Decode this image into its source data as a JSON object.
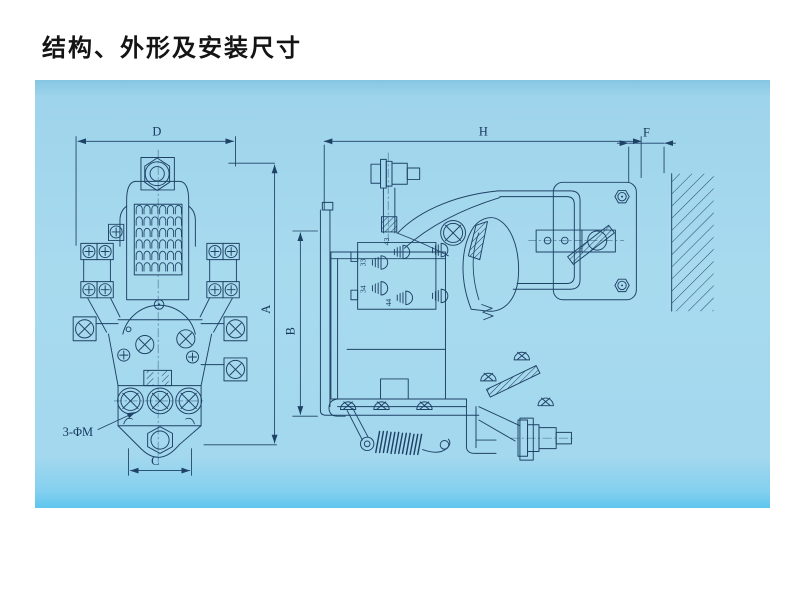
{
  "page": {
    "title": "结构、外形及安装尺寸"
  },
  "figure": {
    "kind": "engineering blueprint, contactor outline and mounting drawing, two views",
    "labels": {
      "d": "D",
      "a": "A",
      "c": "C",
      "holes": "3-ΦM",
      "h": "H",
      "f": "F",
      "b": "B",
      "t43": "43",
      "t33": "33",
      "t34": "34",
      "t44": "44"
    },
    "colors": {
      "page_bg": "#ffffff",
      "panel_bg": "#a8daee",
      "panel_bottom_strip": "#5ec6ee",
      "ink": "#1e4166",
      "title_color": "#141414"
    }
  }
}
